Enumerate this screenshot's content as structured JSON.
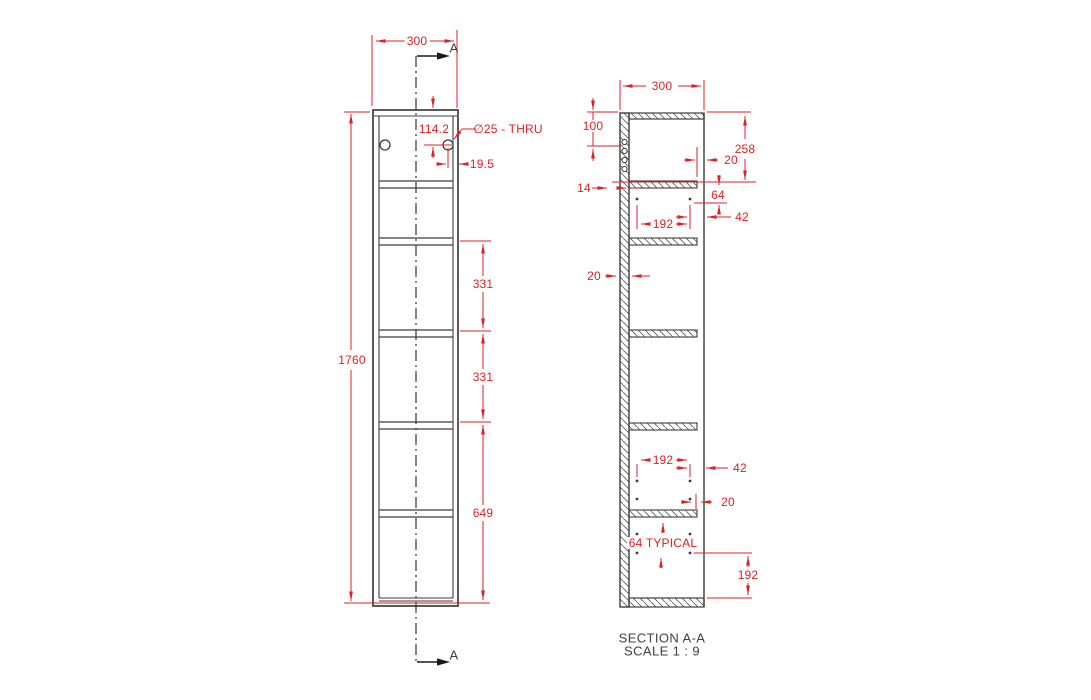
{
  "drawing": {
    "front_view": {
      "dim_width": "300",
      "dim_height": "1760",
      "dim_hole_from_top": "114.2",
      "hole_callout": "∅25 - THRU",
      "dim_hole_from_edge": "19.5",
      "dim_shelf_pitch_1": "331",
      "dim_shelf_pitch_2": "331",
      "dim_bottom_section": "649",
      "section_arrow_label_top": "A",
      "section_arrow_label_bottom": "A"
    },
    "section_view": {
      "dim_depth": "300",
      "dim_top_to_holes": "100",
      "dim_top_shelf_depth": "258",
      "dim_front_setback_top": "20",
      "dim_back_lip": "14",
      "dim_pin_offset_top": "64",
      "dim_pin_span_top": "192",
      "dim_pin_to_front_top": "42",
      "dim_wall_thickness": "20",
      "dim_pin_span_bottom": "192",
      "dim_pin_to_front_bottom": "42",
      "dim_front_setback_bottom": "20",
      "dim_pin_pitch_typical": "64 TYPICAL",
      "dim_bottom_to_holes": "192",
      "title": "SECTION A-A",
      "scale": "SCALE 1 : 9"
    },
    "colors": {
      "dimension_red": "#dd2127",
      "drawing_line": "#3d3d3d",
      "background": "#ffffff"
    }
  }
}
